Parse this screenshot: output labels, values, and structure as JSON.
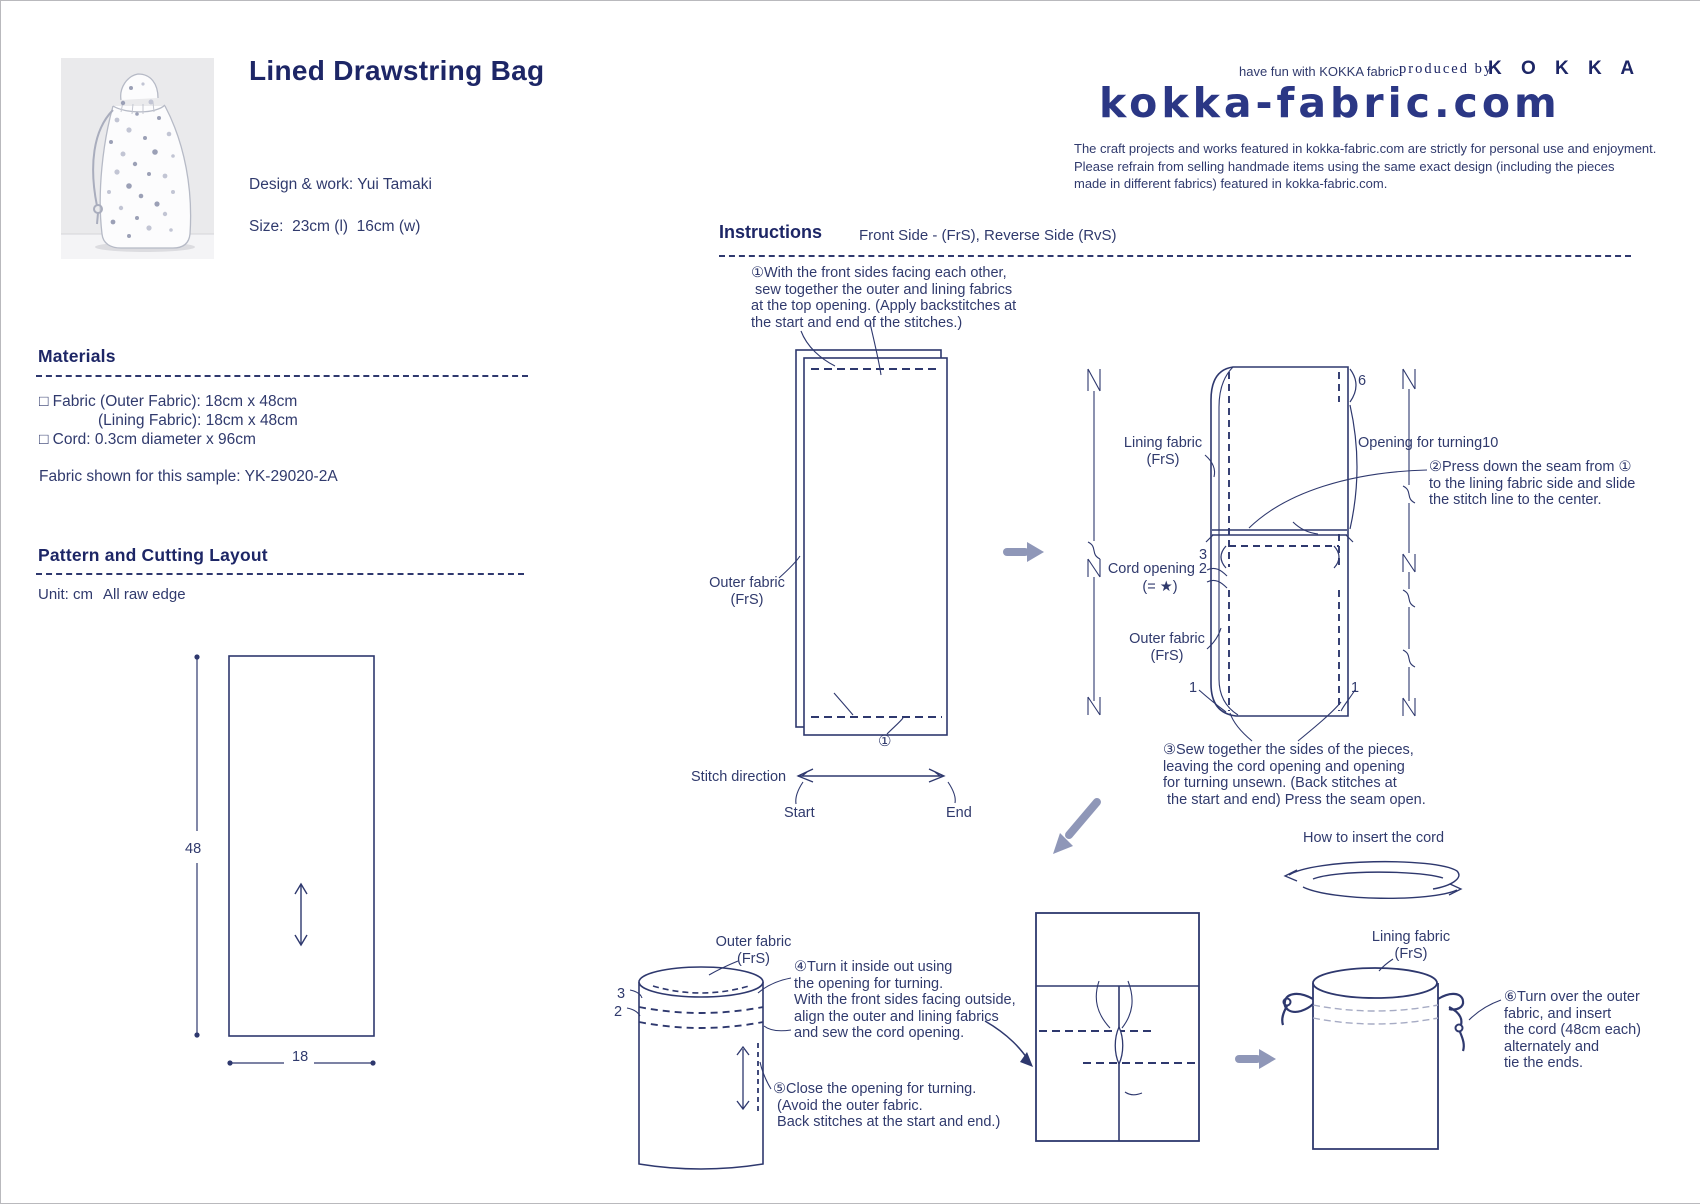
{
  "colors": {
    "ink": "#303a6d",
    "line": "#2e386e",
    "arrow_gray": "#8f97b8",
    "logo_navy": "#2b3785"
  },
  "header": {
    "title": "Lined Drawstring Bag",
    "design": "Design & work: Yui Tamaki",
    "size": "Size:  23cm (l)  16cm (w)"
  },
  "brand": {
    "tagline": "have fun with KOKKA fabric!",
    "produced_by": "produced by",
    "name": "K O K K A",
    "logo": "kokka-fabric.com",
    "disclaimer": "The craft projects and works featured in kokka-fabric.com are strictly for personal use and enjoyment.\nPlease refrain from selling handmade items using the same exact design (including the pieces\nmade in different fabrics) featured in kokka-fabric.com."
  },
  "materials": {
    "heading": "Materials",
    "item1": "□ Fabric (Outer Fabric): 18cm x 48cm",
    "item2": "(Lining Fabric): 18cm x 48cm",
    "item3": "□ Cord: 0.3cm diameter x 96cm",
    "sample": "Fabric shown for this sample: YK-29020-2A"
  },
  "pattern": {
    "heading": "Pattern and Cutting Layout",
    "unit": "Unit: cm",
    "raw_edge": "All raw edge",
    "piece_label": "Outer Fabric ·\nLining Fabric\n(One piece each)",
    "dim_height": "48",
    "dim_width": "18"
  },
  "instructions": {
    "heading": "Instructions",
    "side_note": "Front Side - (FrS), Reverse Side (RvS)",
    "step1": "①With the front sides facing each other,\n sew together the outer and lining fabrics\nat the top opening. (Apply backstitches at\nthe start and end of the stitches.)",
    "step2": "②Press down the seam from ①\nto the lining fabric side and slide\nthe stitch line to the center.",
    "step3": "③Sew together the sides of the pieces,\nleaving the cord opening and opening\nfor turning unsewn. (Back stitches at\n the start and end) Press the seam open.",
    "step4": "④Turn it inside out using\nthe opening for turning.\nWith the front sides facing outside,\nalign the outer and lining fabrics\nand sew the cord opening.",
    "step5": "⑤Close the opening for turning.\n (Avoid the outer fabric.\n Back stitches at the start and end.)",
    "step6": "⑥Turn over the outer\nfabric, and insert\nthe cord (48cm each)\nalternately and\ntie the ends.",
    "cord_note": "How to insert the cord"
  },
  "diagram1": {
    "outer_label": "Outer fabric\n(FrS)",
    "lining_label": "Lining fabric\n(RvS)",
    "seam_top": "1",
    "seam_bottom": "1",
    "step_ref": "①",
    "stitch_direction": "Stitch direction",
    "start": "Start",
    "end": "End"
  },
  "diagram2": {
    "lining_frs": "Lining fabric\n(FrS)",
    "lining_rvs": "Lining fabric\n(RvS)",
    "outer_frs": "Outer fabric\n(FrS)",
    "outer_rvs": "Outer fabric\n(RvS)",
    "opening_side": "Opening\nside",
    "opening_turning": "Opening for turning10",
    "cord_opening": "Cord opening 2",
    "cord_opening_eq": "(= ★)",
    "six": "6",
    "three_left": "3",
    "three_right": "3",
    "star": "★",
    "one_left": "1",
    "one_right": "1"
  },
  "diagram4": {
    "outer_label": "Outer fabric\n(FrS)",
    "lining_label": "Lining fabric\n(FrS)",
    "three": "3",
    "two": "2"
  },
  "diagram5": {
    "note": "No backstitches at\nthe start and end.\nOverlap for approx.\n2-3cm and sew.",
    "outer_label": "Outer fabric\n(FrS)",
    "side": "Side"
  },
  "diagram6": {
    "lining_label": "Lining fabric\n(FrS)",
    "outer_label": "Outer fabric\n(FrS)"
  }
}
